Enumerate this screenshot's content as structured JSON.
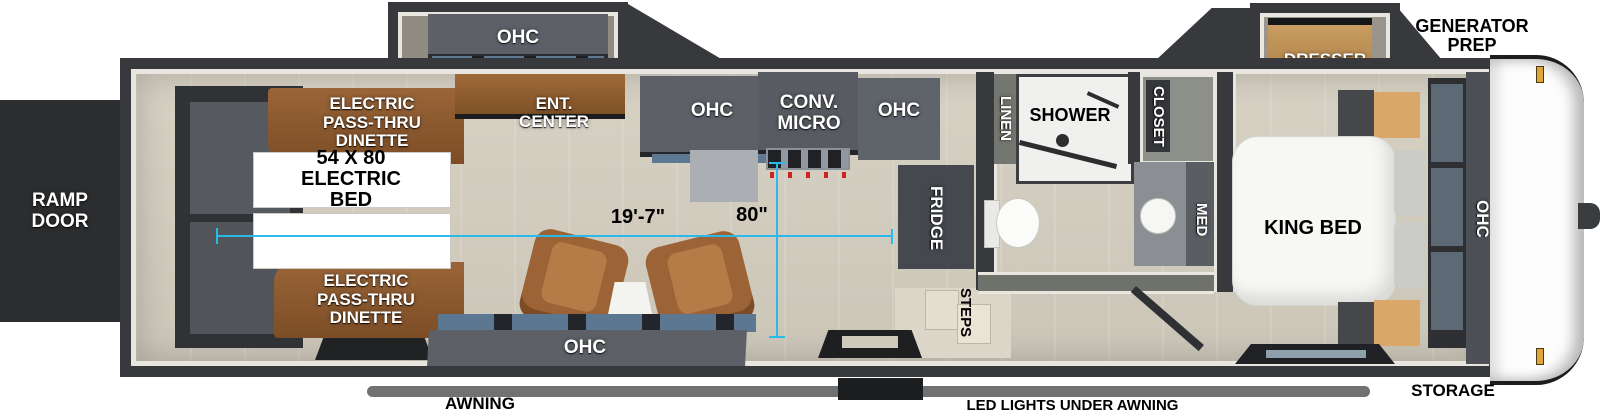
{
  "colors": {
    "accent_dim": "#2BB9E9",
    "wall": "#37393C",
    "floor": "#D2CCBF",
    "wood": "#8A5731",
    "recliner": "#A8703E",
    "cabinet": "#5D6167",
    "amber_light": "#DFA43A"
  },
  "exterior": {
    "ramp_door": "RAMP DOOR",
    "generator_prep": "GENERATOR PREP",
    "storage": "STORAGE",
    "awning": "AWNING",
    "led_lights": "LED LIGHTS UNDER AWNING"
  },
  "dimensions": {
    "interior_length": "19'-7\"",
    "interior_width": "80\""
  },
  "garage": {
    "dinette_top": "ELECTRIC PASS-THRU DINETTE",
    "electric_bed": "54 X 80 ELECTRIC BED",
    "dinette_bottom": "ELECTRIC PASS-THRU DINETTE"
  },
  "living": {
    "slide_ohc": "OHC",
    "ent_center": "ENT. CENTER",
    "sofa_ohc": "OHC"
  },
  "kitchen": {
    "ohc_left": "OHC",
    "conv_micro": "CONV. MICRO",
    "ohc_right": "OHC",
    "fridge": "FRIDGE",
    "steps": "STEPS"
  },
  "bathroom": {
    "linen": "LINEN",
    "shower": "SHOWER",
    "closet": "CLOSET",
    "med": "MED"
  },
  "bedroom": {
    "dresser": "DRESSER",
    "king_bed": "KING BED",
    "ohc": "OHC"
  }
}
